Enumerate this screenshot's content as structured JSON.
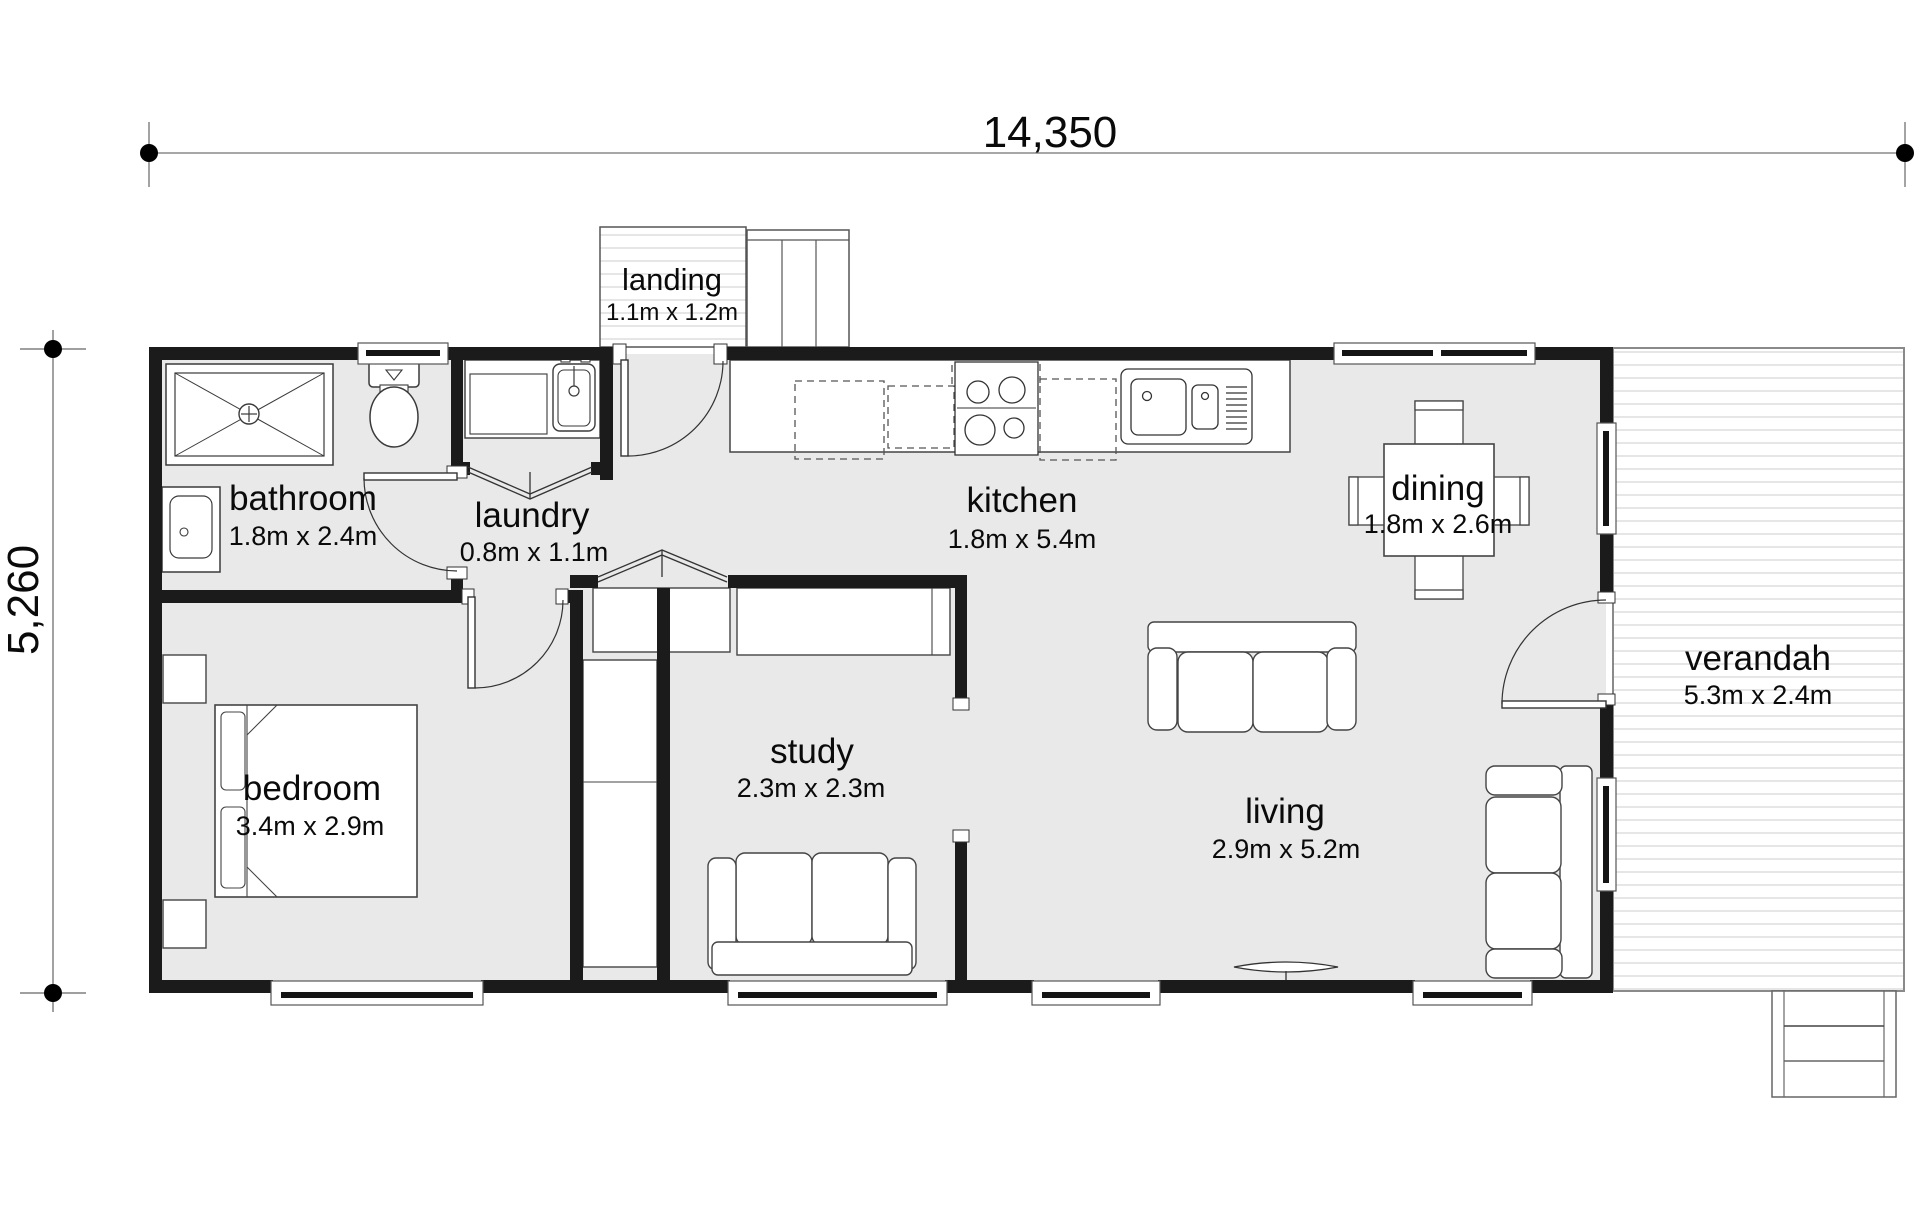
{
  "plan": {
    "overall_width": "14,350",
    "overall_height": "5,260",
    "rooms": {
      "landing": {
        "name": "landing",
        "size": "1.1m x 1.2m"
      },
      "bathroom": {
        "name": "bathroom",
        "size": "1.8m x 2.4m"
      },
      "laundry": {
        "name": "laundry",
        "size": "0.8m x 1.1m"
      },
      "kitchen": {
        "name": "kitchen",
        "size": "1.8m x 5.4m"
      },
      "dining": {
        "name": "dining",
        "size": "1.8m x 2.6m"
      },
      "verandah": {
        "name": "verandah",
        "size": "5.3m x 2.4m"
      },
      "bedroom": {
        "name": "bedroom",
        "size": "3.4m x 2.9m"
      },
      "study": {
        "name": "study",
        "size": "2.3m x 2.3m"
      },
      "living": {
        "name": "living",
        "size": "2.9m x 5.2m"
      }
    },
    "colors": {
      "wall": "#1b1b1b",
      "floor": "#e9e9e9",
      "deck_stripe": "#e0e0e0",
      "furniture_stroke": "#3a3a3a"
    }
  }
}
